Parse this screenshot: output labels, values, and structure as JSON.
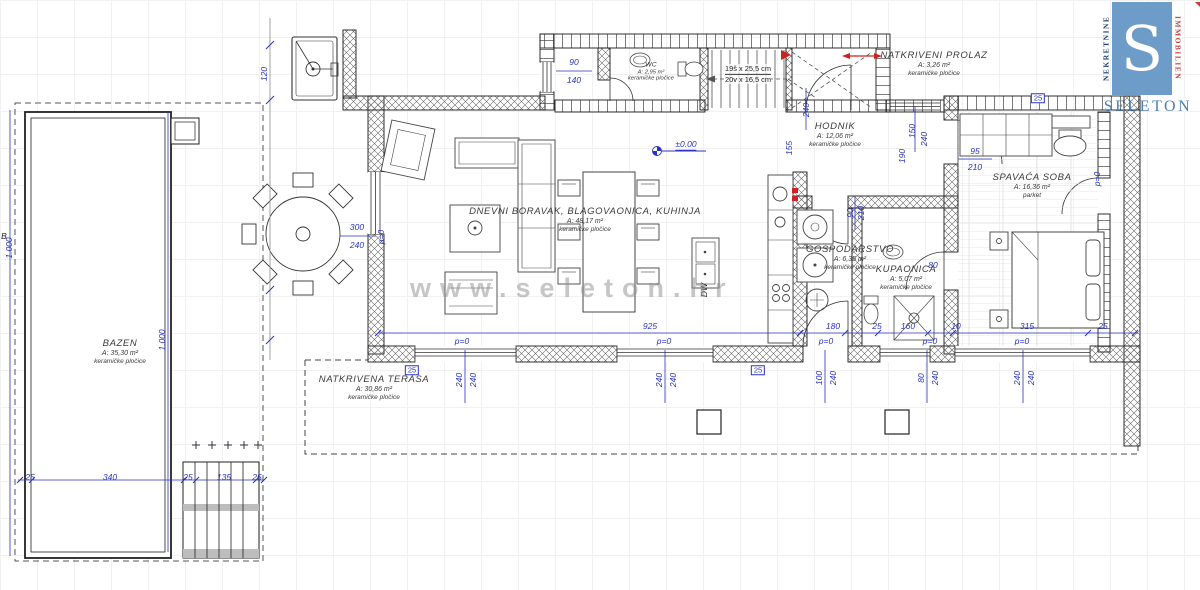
{
  "logo": {
    "monogram": "S",
    "brand": "SELETON",
    "left_vertical": "NEKRETNINE",
    "right_vertical": "IMMOBILIEN",
    "colors": {
      "square": "#6d9cc9",
      "brand": "#4e7fb7",
      "nekretnine": "#1c3a6e",
      "immobilien": "#c64040",
      "triangle": "#d23b33"
    }
  },
  "watermark": "www.seleton.hr",
  "plan": {
    "colors": {
      "dimension_blue": "#2a33bb",
      "wall_line": "#222222",
      "red_marker": "#cc2222",
      "watermark_gray": "#8f8f8f"
    },
    "stairs_note": {
      "line1": "19š x 25,5 cm",
      "line2": "20v x 16,5 cm"
    },
    "rooms": [
      {
        "id": "bazen",
        "name": "BAZEN",
        "area": "A: 35,30 m²",
        "floor": "keramičke pločice",
        "x": 120,
        "y": 352
      },
      {
        "id": "natkrivena-terasa",
        "name": "NATKRIVENA TERASA",
        "area": "A: 30,86 m²",
        "floor": "keramičke pločice",
        "x": 374,
        "y": 388
      },
      {
        "id": "dnevni-boravak",
        "name": "DNEVNI BORAVAK, BLAGOVAONICA, KUHINJA",
        "area": "A: 48,17 m²",
        "floor": "keramičke pločice",
        "x": 585,
        "y": 220
      },
      {
        "id": "wc",
        "name": "WC",
        "area": "A: 2,95 m²",
        "floor": "keramičke pločice",
        "x": 651,
        "y": 72,
        "small": true
      },
      {
        "id": "natkriveni-prolaz",
        "name": "NATKRIVENI PROLAZ",
        "area": "A: 3,26 m²",
        "floor": "keramičke pločice",
        "x": 934,
        "y": 64
      },
      {
        "id": "hodnik",
        "name": "HODNIK",
        "area": "A: 12,06 m²",
        "floor": "keramičke pločice",
        "x": 835,
        "y": 135
      },
      {
        "id": "gospodarstvo",
        "name": "GOSPODARSTVO",
        "area": "A: 6,35 m²",
        "floor": "keramičke pločice",
        "x": 850,
        "y": 258
      },
      {
        "id": "kupaonica",
        "name": "KUPAONICA",
        "area": "A: 5,07 m²",
        "floor": "keramičke pločice",
        "x": 906,
        "y": 278
      },
      {
        "id": "spavaca-soba",
        "name": "SPAVAĆA SOBA",
        "area": "A: 16,36 m²",
        "floor": "parket",
        "x": 1032,
        "y": 186
      }
    ],
    "dimensions": [
      {
        "t": "90",
        "x": 574,
        "y": 62
      },
      {
        "t": "140",
        "x": 574,
        "y": 80
      },
      {
        "t": "300",
        "x": 357,
        "y": 227
      },
      {
        "t": "240",
        "x": 357,
        "y": 245
      },
      {
        "t": "p=0",
        "x": 381,
        "y": 237,
        "r": 1
      },
      {
        "t": "120",
        "x": 264,
        "y": 74,
        "r": 1
      },
      {
        "t": "1.000",
        "x": 9,
        "y": 248,
        "r": 1
      },
      {
        "t": "1.000",
        "x": 162,
        "y": 340,
        "r": 1
      },
      {
        "t": "25",
        "x": 30,
        "y": 477
      },
      {
        "t": "340",
        "x": 110,
        "y": 477
      },
      {
        "t": "25",
        "x": 188,
        "y": 477
      },
      {
        "t": "135",
        "x": 224,
        "y": 477
      },
      {
        "t": "25",
        "x": 257,
        "y": 477
      },
      {
        "t": "925",
        "x": 650,
        "y": 326
      },
      {
        "t": "180",
        "x": 833,
        "y": 326
      },
      {
        "t": "25",
        "x": 877,
        "y": 326
      },
      {
        "t": "160",
        "x": 908,
        "y": 326
      },
      {
        "t": "10",
        "x": 956,
        "y": 326
      },
      {
        "t": "315",
        "x": 1027,
        "y": 326
      },
      {
        "t": "25",
        "x": 1103,
        "y": 326
      },
      {
        "t": "p=0",
        "x": 462,
        "y": 341
      },
      {
        "t": "p=0",
        "x": 664,
        "y": 341
      },
      {
        "t": "p=0",
        "x": 826,
        "y": 341
      },
      {
        "t": "p=0",
        "x": 930,
        "y": 341
      },
      {
        "t": "p=0",
        "x": 1022,
        "y": 341
      },
      {
        "t": "240",
        "x": 459,
        "y": 380,
        "r": 1
      },
      {
        "t": "240",
        "x": 473,
        "y": 380,
        "r": 1
      },
      {
        "t": "240",
        "x": 659,
        "y": 380,
        "r": 1
      },
      {
        "t": "240",
        "x": 673,
        "y": 380,
        "r": 1
      },
      {
        "t": "100",
        "x": 819,
        "y": 378,
        "r": 1
      },
      {
        "t": "240",
        "x": 833,
        "y": 378,
        "r": 1
      },
      {
        "t": "80",
        "x": 921,
        "y": 378,
        "r": 1
      },
      {
        "t": "240",
        "x": 935,
        "y": 378,
        "r": 1
      },
      {
        "t": "240",
        "x": 1017,
        "y": 378,
        "r": 1
      },
      {
        "t": "240",
        "x": 1031,
        "y": 378,
        "r": 1
      },
      {
        "t": "25",
        "x": 412,
        "y": 370,
        "boxed": 1
      },
      {
        "t": "25",
        "x": 758,
        "y": 370,
        "boxed": 1
      },
      {
        "t": "25",
        "x": 1038,
        "y": 98,
        "boxed": 1
      },
      {
        "t": "155",
        "x": 789,
        "y": 148,
        "r": 1
      },
      {
        "t": "190",
        "x": 902,
        "y": 156,
        "r": 1
      },
      {
        "t": "150",
        "x": 912,
        "y": 131,
        "r": 1
      },
      {
        "t": "240",
        "x": 924,
        "y": 139,
        "r": 1
      },
      {
        "t": "240",
        "x": 806,
        "y": 110,
        "r": 1
      },
      {
        "t": "90",
        "x": 850,
        "y": 213,
        "r": 1
      },
      {
        "t": "210",
        "x": 861,
        "y": 213,
        "r": 1
      },
      {
        "t": "95",
        "x": 975,
        "y": 151
      },
      {
        "t": "210",
        "x": 975,
        "y": 167
      },
      {
        "t": "80",
        "x": 933,
        "y": 265
      },
      {
        "t": "p=0",
        "x": 1097,
        "y": 179,
        "r": 1
      },
      {
        "t": "±0.00",
        "x": 686,
        "y": 145,
        "u": 1
      },
      {
        "t": "DW",
        "x": 704,
        "y": 290,
        "r": 1,
        "k": 1
      },
      {
        "t": "B",
        "x": 4,
        "y": 236,
        "k": 1
      }
    ]
  }
}
